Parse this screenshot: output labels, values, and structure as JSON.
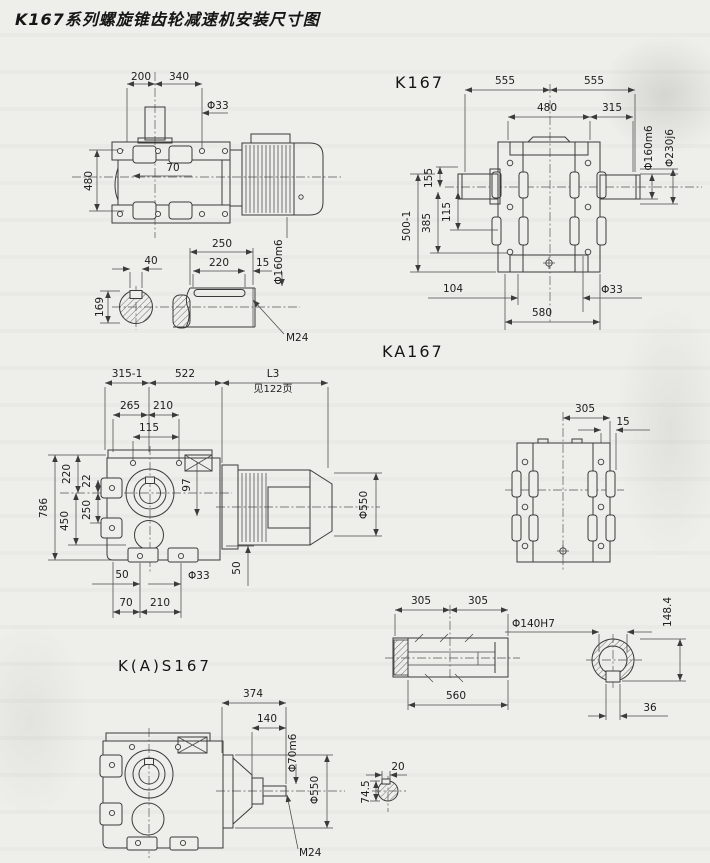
{
  "title": "K167系列螺旋锥齿轮减速机安装尺寸图",
  "sections": {
    "top_side": {
      "d200": "200",
      "d340": "340",
      "d33": "Φ33",
      "d70": "70",
      "d480": "480"
    },
    "shaft_detail": {
      "d40": "40",
      "d169": "169",
      "d250": "250",
      "d220": "220",
      "d15": "15",
      "d160": "Φ160m6",
      "m24": "M24"
    },
    "k167": {
      "label": "K167",
      "d555a": "555",
      "d555b": "555",
      "d480": "480",
      "d315": "315",
      "d160": "Φ160m6",
      "d230": "Φ230j6",
      "d155": "155",
      "d500": "500-1",
      "d385": "385",
      "d115": "115",
      "d104": "104",
      "d33": "Φ33",
      "d580": "580"
    },
    "ka167": {
      "label": "KA167",
      "d315_1": "315-1",
      "d522": "522",
      "l3": "L3",
      "l3_ref": "见122页",
      "d265": "265",
      "d210": "210",
      "d115": "115",
      "d786": "786",
      "d220": "220",
      "d22": "22",
      "d250": "250",
      "d450": "450",
      "d97": "97",
      "d550": "Φ550",
      "d50a": "50",
      "d33": "Φ33",
      "d50b": "50",
      "d70": "70",
      "d210b": "210"
    },
    "rear": {
      "d305": "305",
      "d15": "15"
    },
    "hollow_shaft": {
      "d305a": "305",
      "d305b": "305",
      "d560": "560",
      "d140": "Φ140H7",
      "d148": "148.4",
      "d36": "36"
    },
    "kas167": {
      "label": "K(A)S167",
      "d374": "374",
      "d140": "140",
      "d70": "Φ70m6",
      "d550": "Φ550",
      "m24": "M24",
      "d745": "74.5",
      "d20": "20"
    }
  }
}
